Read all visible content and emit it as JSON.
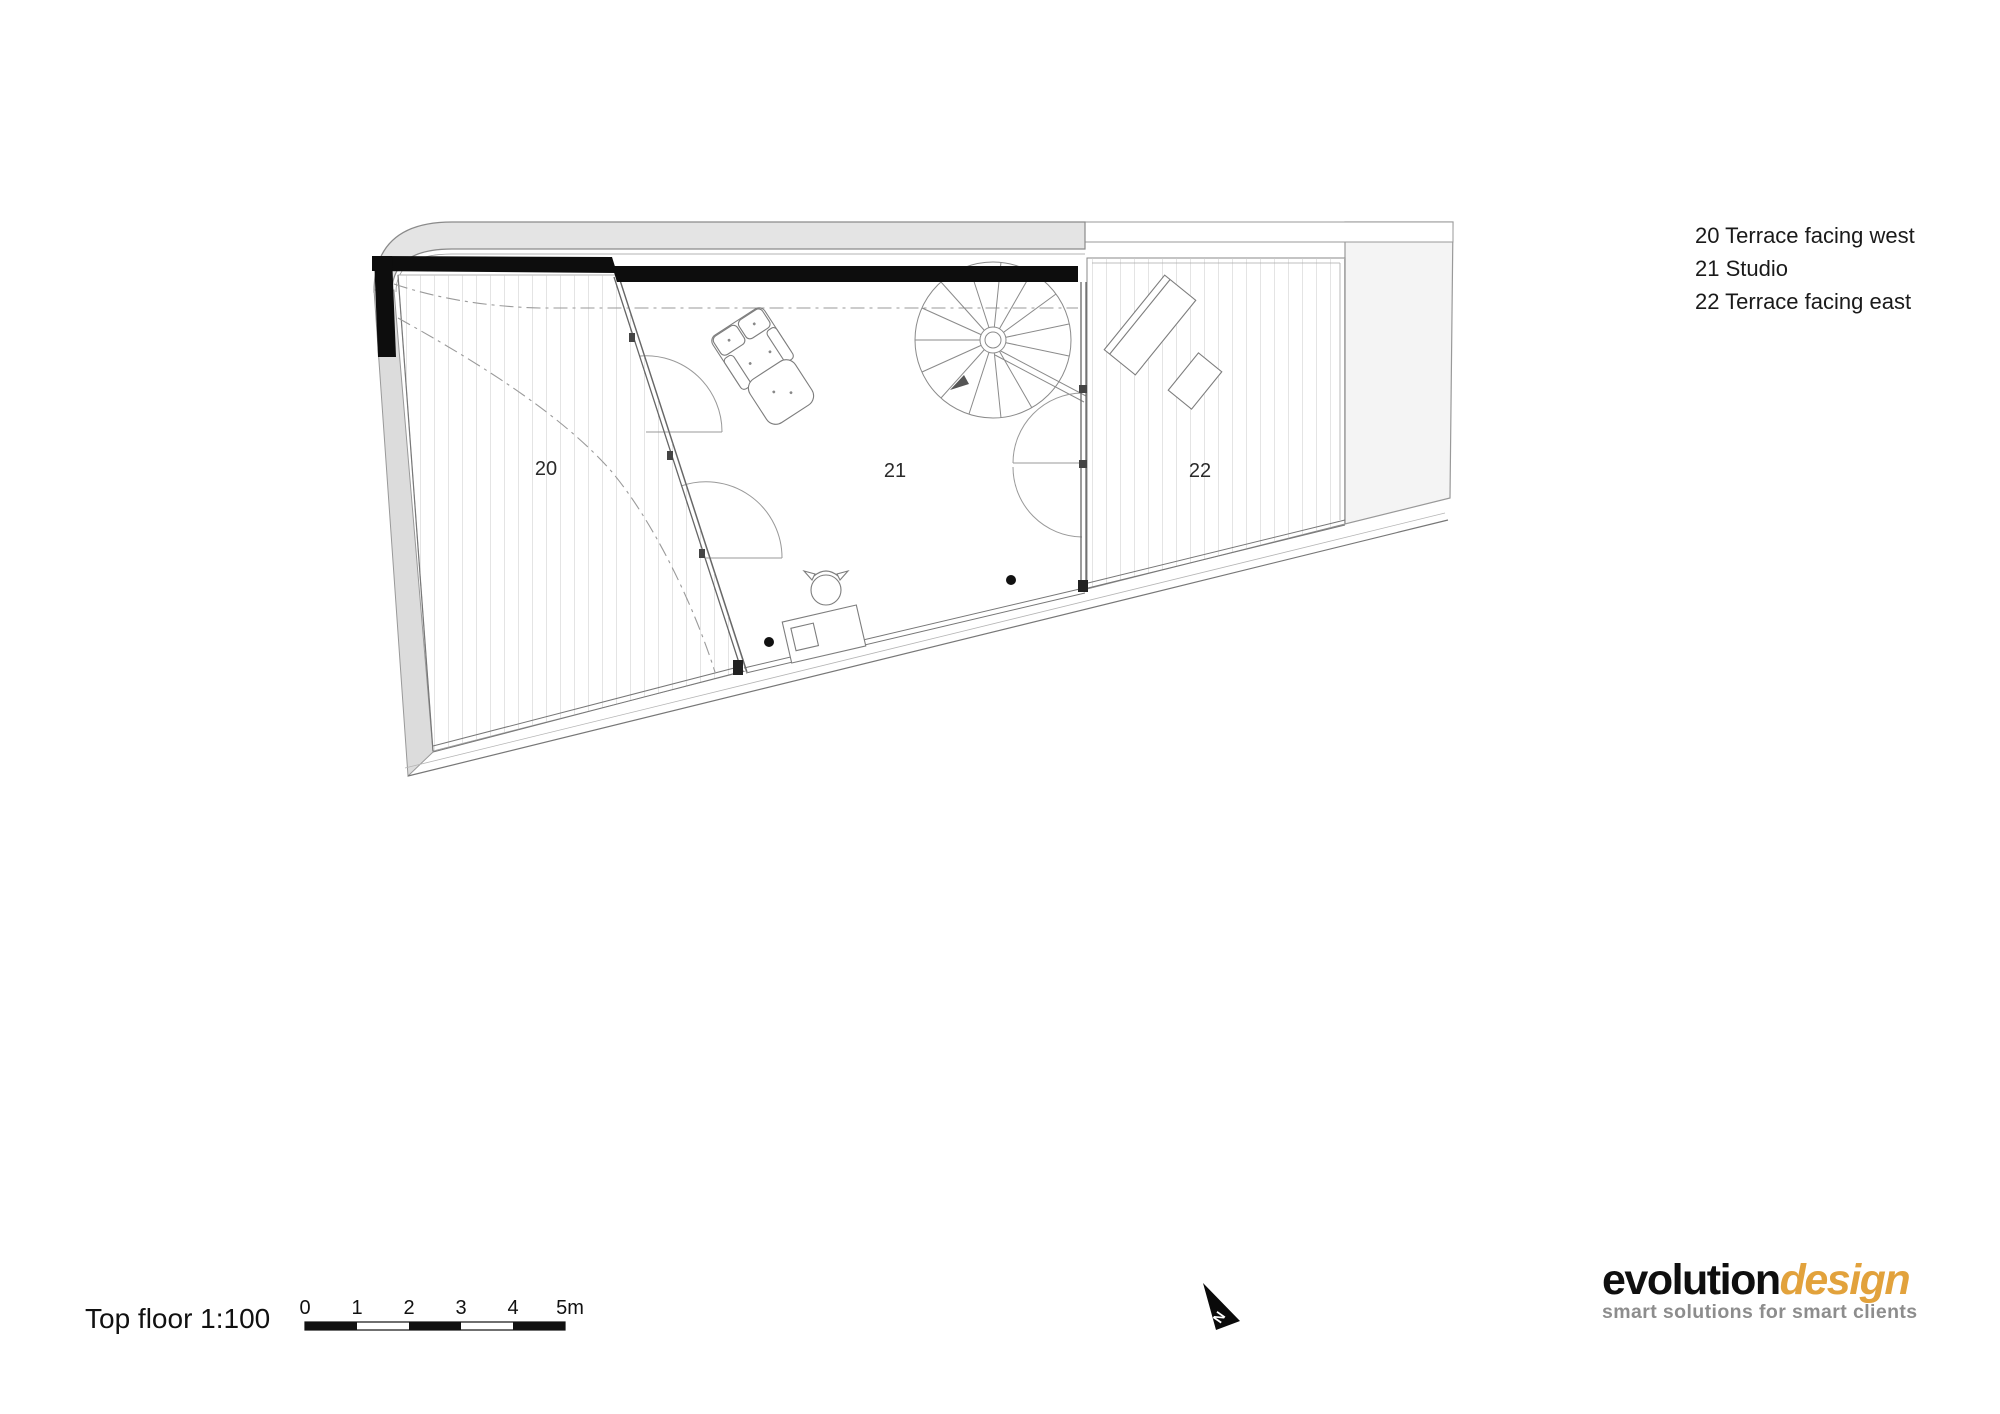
{
  "document": {
    "title": "Top floor 1:100"
  },
  "legend": {
    "items": [
      "20 Terrace facing west",
      "21 Studio",
      "22 Terrace facing east"
    ]
  },
  "rooms": {
    "terrace_west": "20",
    "studio": "21",
    "terrace_east": "22"
  },
  "scale_bar": {
    "ticks": [
      "0",
      "1",
      "2",
      "3",
      "4",
      "5m"
    ],
    "unit": "m",
    "ratio": "1:100"
  },
  "compass": {
    "label": "N"
  },
  "logo": {
    "name_primary": "evolution",
    "name_secondary": "design",
    "tagline": "smart solutions for smart clients",
    "accent_color": "#E2A23C"
  },
  "colors": {
    "wall_black": "#0d0d0d",
    "roof_gray": "#e4e4e4",
    "edge_gray": "#dcdcdc",
    "hatch_gray": "#c9c9c9",
    "line_gray": "#777777"
  }
}
